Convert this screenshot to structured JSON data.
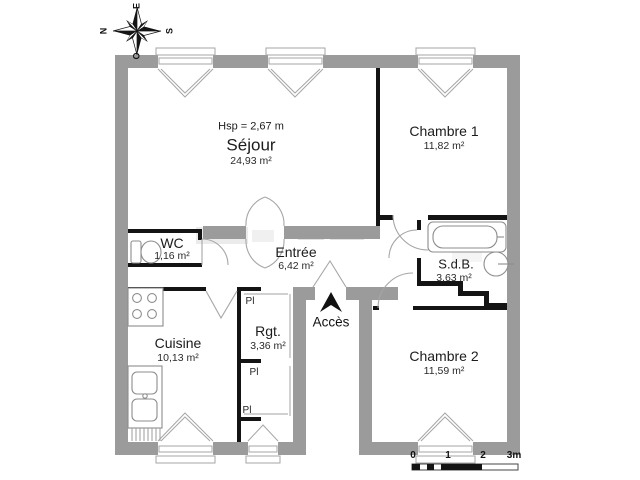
{
  "palette": {
    "background": "#ffffff",
    "wall_gray": "#9b9b9b",
    "wall_black": "#141414",
    "thin_line": "#a6a6a6",
    "text": "#1c1c1c",
    "watermark": "#dcdcdc"
  },
  "compass": {
    "top": "E",
    "left": "N",
    "right": "S",
    "bottom": "O"
  },
  "ceiling_note": "Hsp = 2,67 m",
  "rooms": [
    {
      "name": "Séjour",
      "area": "24,93 m²"
    },
    {
      "name": "Chambre 1",
      "area": "11,82 m²"
    },
    {
      "name": "WC",
      "area": "1,16 m²"
    },
    {
      "name": "Entrée",
      "area": "6,42 m²"
    },
    {
      "name": "S.d.B.",
      "area": "3,63 m²"
    },
    {
      "name": "Cuisine",
      "area": "10,13 m²"
    },
    {
      "name": "Rgt.",
      "area": "3,36 m²"
    },
    {
      "name": "Chambre 2",
      "area": "11,59 m²"
    }
  ],
  "labels": {
    "access": "Accès",
    "closet": "Pl"
  },
  "scale_bar": {
    "ticks": [
      "0",
      "1",
      "2",
      "3m"
    ]
  }
}
